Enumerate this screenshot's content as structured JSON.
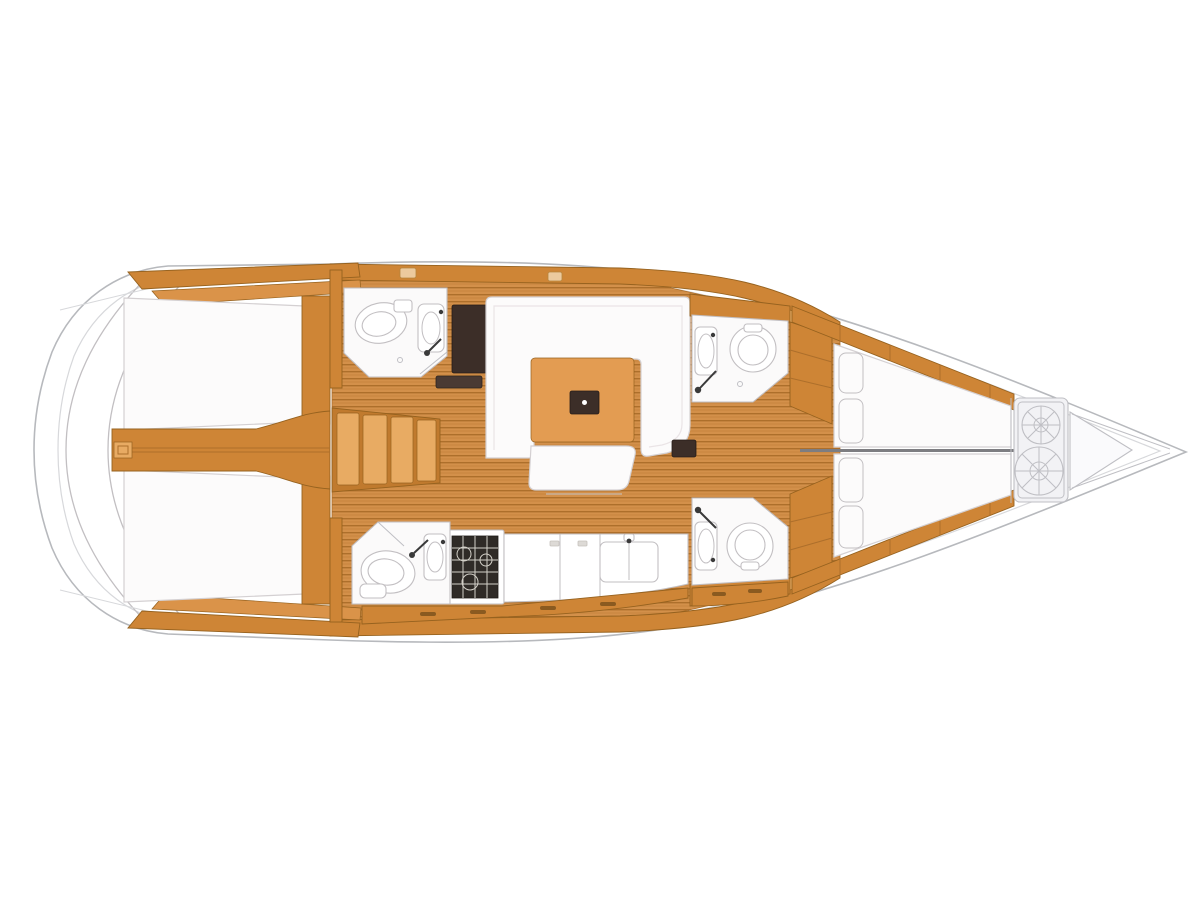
{
  "page": {
    "title": "Sailing yacht interior layout plan",
    "description": "Top-down interior floor plan of a sailing yacht, bow pointing right: two aft double cabins, companionway steps, aft head, U-shaped salon settee with table, linear galley with stove and twin sink, two forward heads, forward V-berth cabin and bow anchor locker",
    "background": "#ffffff"
  },
  "colors": {
    "page_bg": "#ffffff",
    "deck": "#ffffff",
    "hull_stroke": "#b7b9bd",
    "hull_inner": "#d7d8db",
    "wood": "#ce8536",
    "wood_light": "#e8ab63",
    "wood_mid": "#da9349",
    "wood_dark": "#c07a2e",
    "wood_stroke": "#96621f",
    "floor": "#d3904a",
    "floor_line": "#ad6f2b",
    "table": "#e39c52",
    "upholstery": "#fcfbfb",
    "upholstery_stroke": "#d4d0d2",
    "dark_panel": "#3c2e28",
    "dark_soft": "#4a3a33",
    "stove": "#2f2b27",
    "stove_grid": "#d3d0c8",
    "fixture_stroke": "#c2bfc2",
    "gray_fill": "#f2f2f5",
    "gray_stroke": "#bfbfc4"
  },
  "regions": {
    "transom": "stern-swim-platform",
    "aft_cabin_top": "aft-double-cabin-top",
    "aft_cabin_bottom": "aft-double-cabin-bottom",
    "engine_box": "engine-compartment",
    "companionway": "companionway-steps",
    "aft_head": "aft-head-wc",
    "chart_panel": "dark-locker-panel",
    "salon": "salon-u-settee-and-table",
    "galley": "galley-stove-and-sinks",
    "galley_head": "shower-head-aft-of-galley",
    "forward_head_top": "forward-head-top",
    "forward_head_bottom": "forward-head-bottom",
    "forward_cabin": "forward-v-berth-cabin",
    "anchor_locker": "bow-anchor-locker"
  }
}
